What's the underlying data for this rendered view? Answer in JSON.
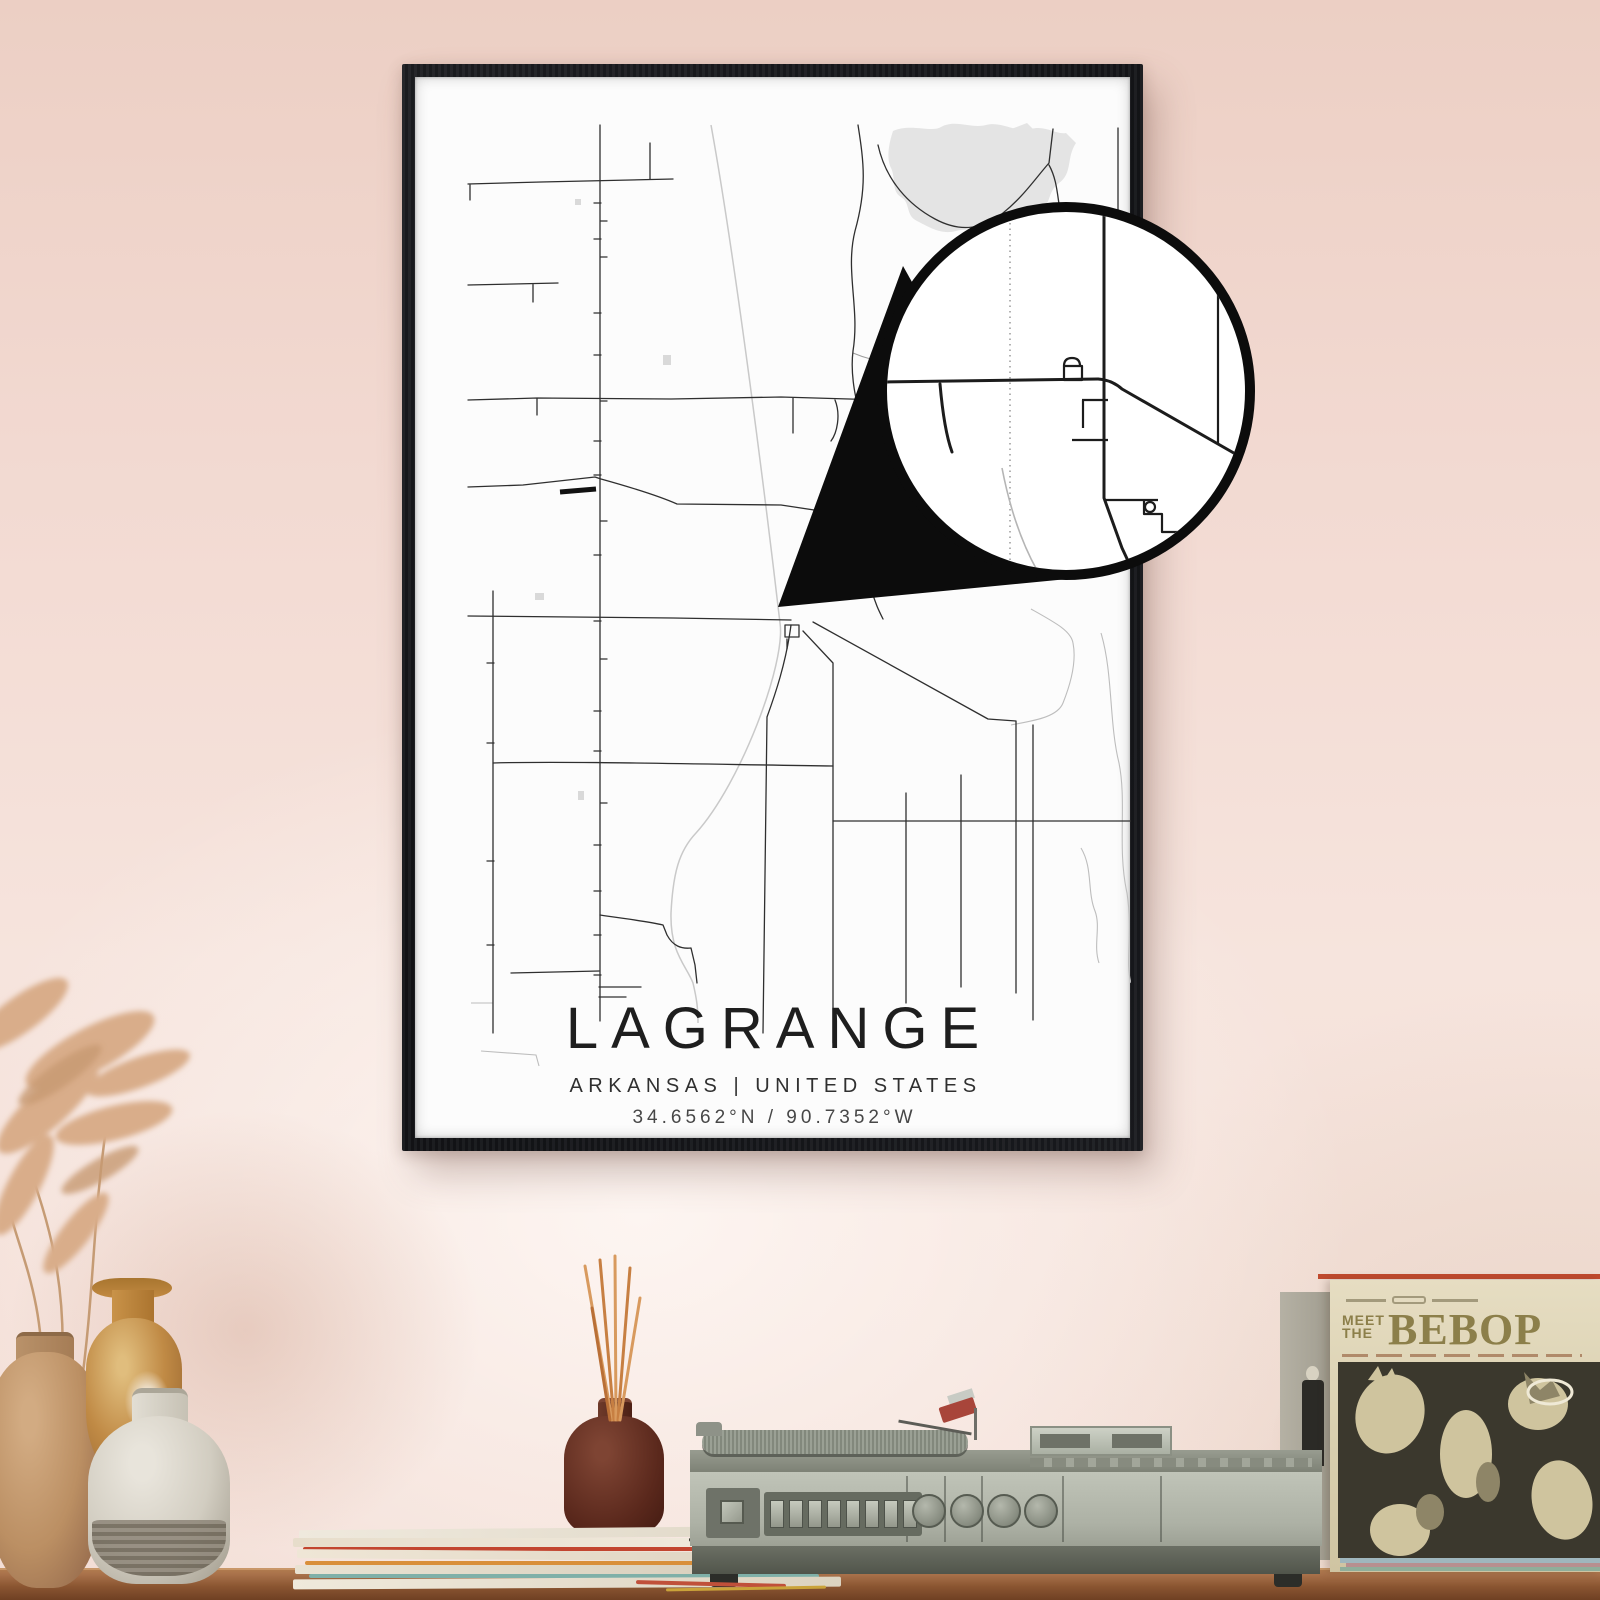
{
  "poster": {
    "title": "LAGRANGE",
    "subtitle": "ARKANSAS | UNITED STATES",
    "coordinates": "34.6562°N / 90.7352°W"
  },
  "sleeve": {
    "meet": "MEET",
    "the": "THE",
    "title": "BEBOP"
  },
  "icons": {
    "magnifier": "magnifier-circle-with-pointer"
  },
  "colors": {
    "wall_pink": "#f2d9d1",
    "frame_black": "#17181b",
    "poster_white": "#fcfcfc",
    "road_dark": "#2f2f2f",
    "road_medium": "#8c8c8c",
    "road_light": "#c9c9c9",
    "water_gray": "#e4e4e4",
    "bold_road": "#111111",
    "shelf_wood": "#8a5531",
    "sleeve_cream": "#ded4b6",
    "sleeve_olive": "#8c7f4a",
    "accent_red": "#c04a2e",
    "vase_tan": "#bb8f63",
    "vase_ochre": "#c08a45",
    "vase_white": "#d2cdc1",
    "bottle_brown": "#5a281c",
    "player_gray": "#adb1a5"
  }
}
